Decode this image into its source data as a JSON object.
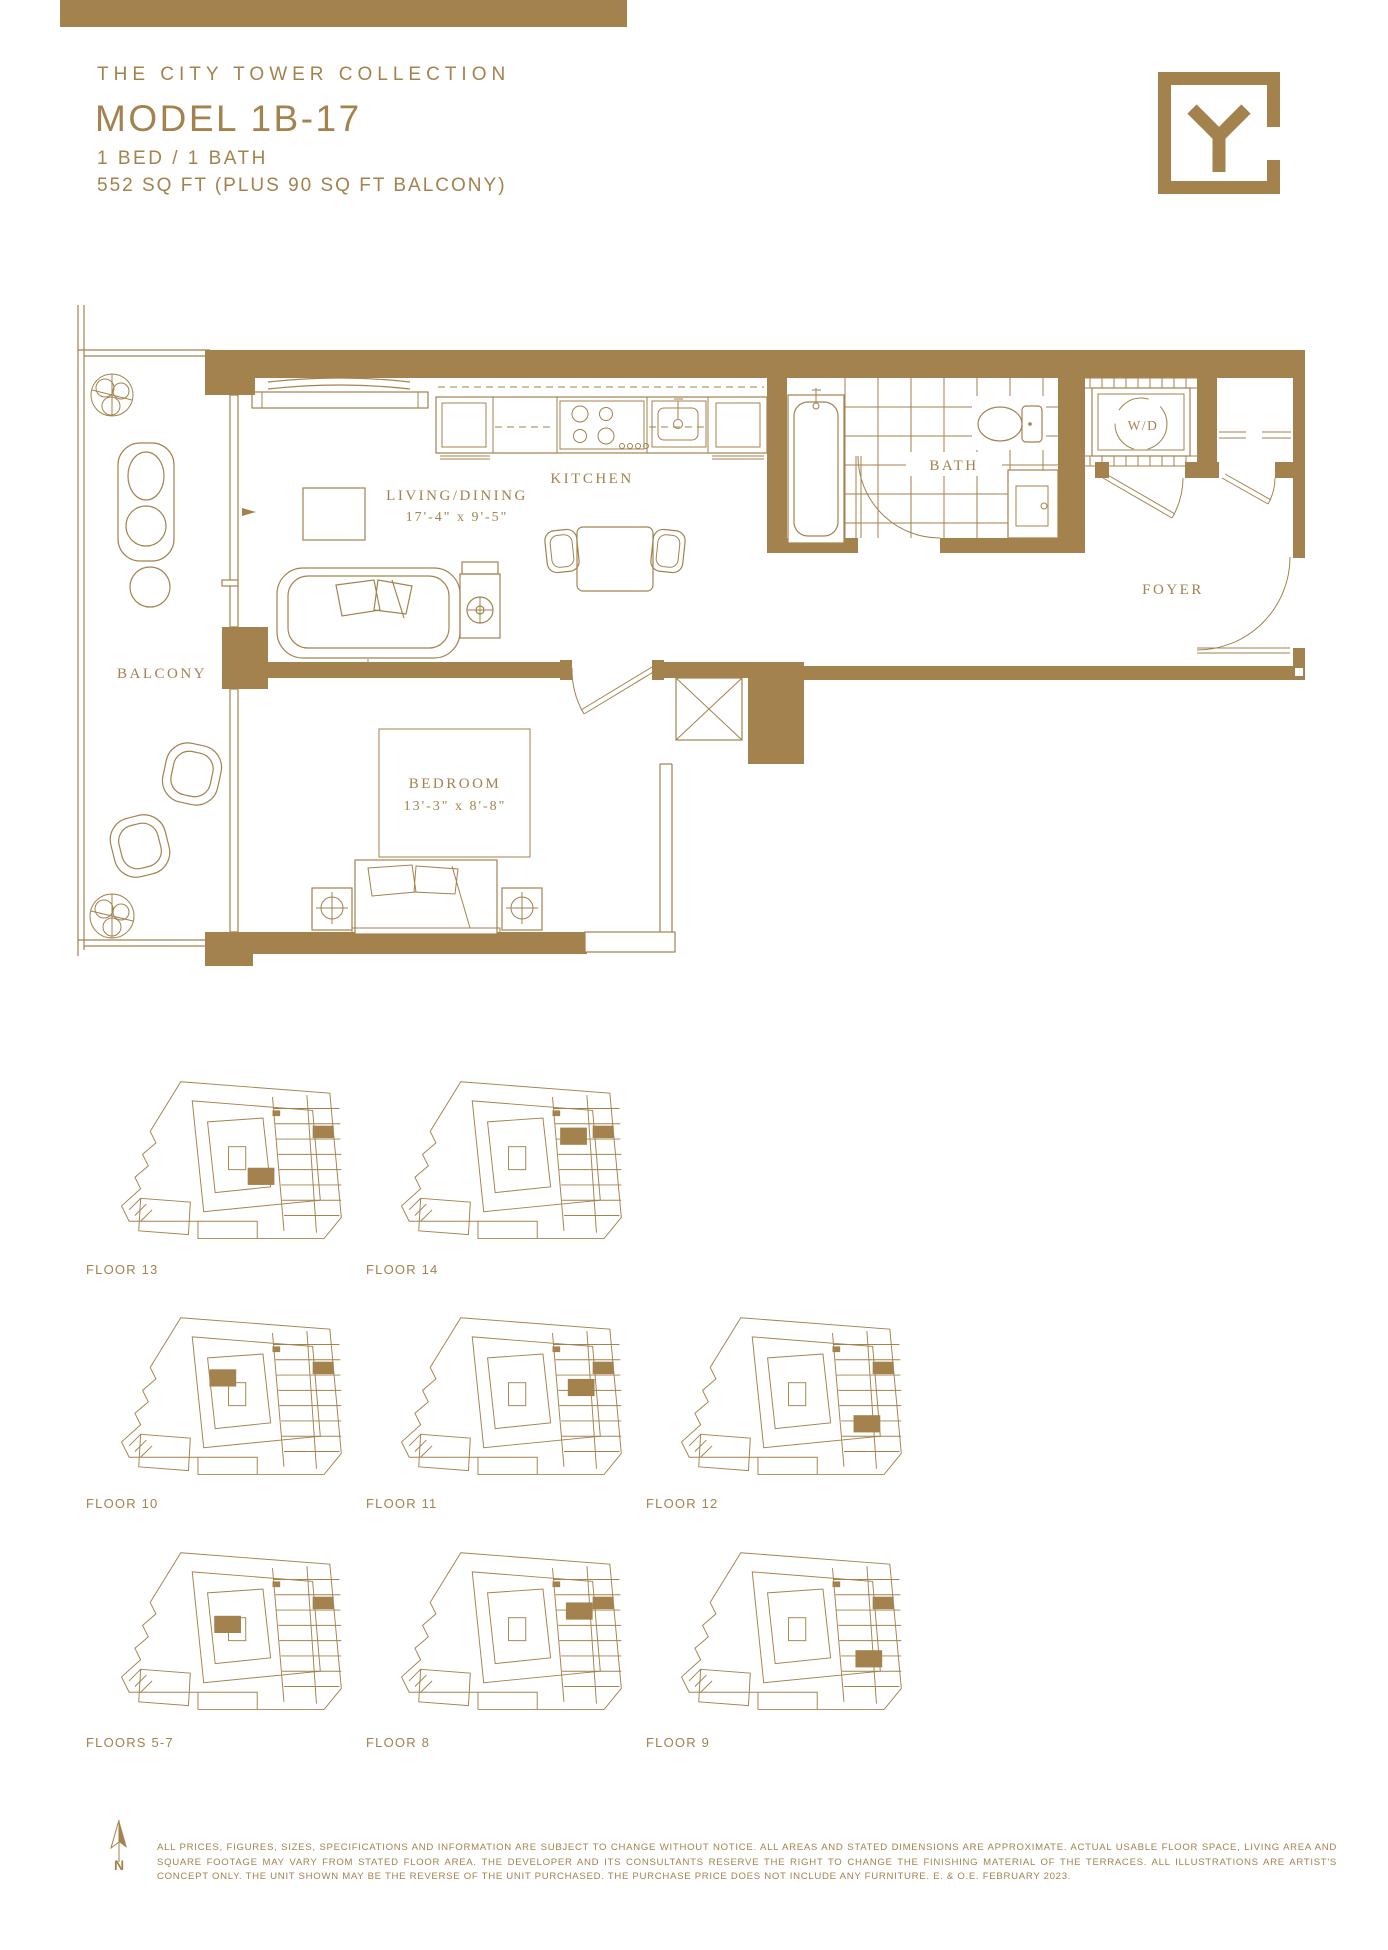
{
  "colors": {
    "gold": "#A3824E",
    "background": "#FFFFFF"
  },
  "header": {
    "collection": "THE CITY TOWER COLLECTION",
    "model": "MODEL 1B-17",
    "bed_bath": "1 BED / 1 BATH",
    "area": "552 SQ FT (PLUS 90 SQ FT BALCONY)"
  },
  "logo": {
    "letter": "Y"
  },
  "plan": {
    "living": {
      "name": "LIVING/DINING",
      "dims": "17'-4\" x 9'-5\""
    },
    "kitchen": {
      "name": "KITCHEN"
    },
    "bath": {
      "name": "BATH"
    },
    "laundry": {
      "name": "W/D"
    },
    "foyer": {
      "name": "FOYER"
    },
    "balcony": {
      "name": "BALCONY"
    },
    "bedroom": {
      "name": "BEDROOM",
      "dims": "13'-3\" x 8'-8\""
    }
  },
  "keyplans": [
    {
      "label": "FLOOR 13"
    },
    {
      "label": "FLOOR 14"
    },
    {
      "label": "FLOOR 10"
    },
    {
      "label": "FLOOR 11"
    },
    {
      "label": "FLOOR 12"
    },
    {
      "label": "FLOORS 5-7"
    },
    {
      "label": "FLOOR 8"
    },
    {
      "label": "FLOOR 9"
    }
  ],
  "footer": {
    "north": "N",
    "disclaimer": "ALL PRICES, FIGURES, SIZES, SPECIFICATIONS AND INFORMATION ARE SUBJECT TO CHANGE WITHOUT NOTICE. ALL AREAS AND STATED DIMENSIONS ARE APPROXIMATE. ACTUAL USABLE FLOOR SPACE, LIVING AREA AND SQUARE FOOTAGE MAY VARY FROM STATED FLOOR AREA. THE DEVELOPER AND ITS CONSULTANTS RESERVE THE RIGHT TO CHANGE THE FINISHING MATERIAL OF THE TERRACES. ALL ILLUSTRATIONS ARE ARTIST'S CONCEPT ONLY. THE UNIT SHOWN MAY BE THE REVERSE OF THE UNIT PURCHASED. THE PURCHASE PRICE DOES NOT INCLUDE ANY FURNITURE. E. & O.E. FEBRUARY 2023."
  }
}
